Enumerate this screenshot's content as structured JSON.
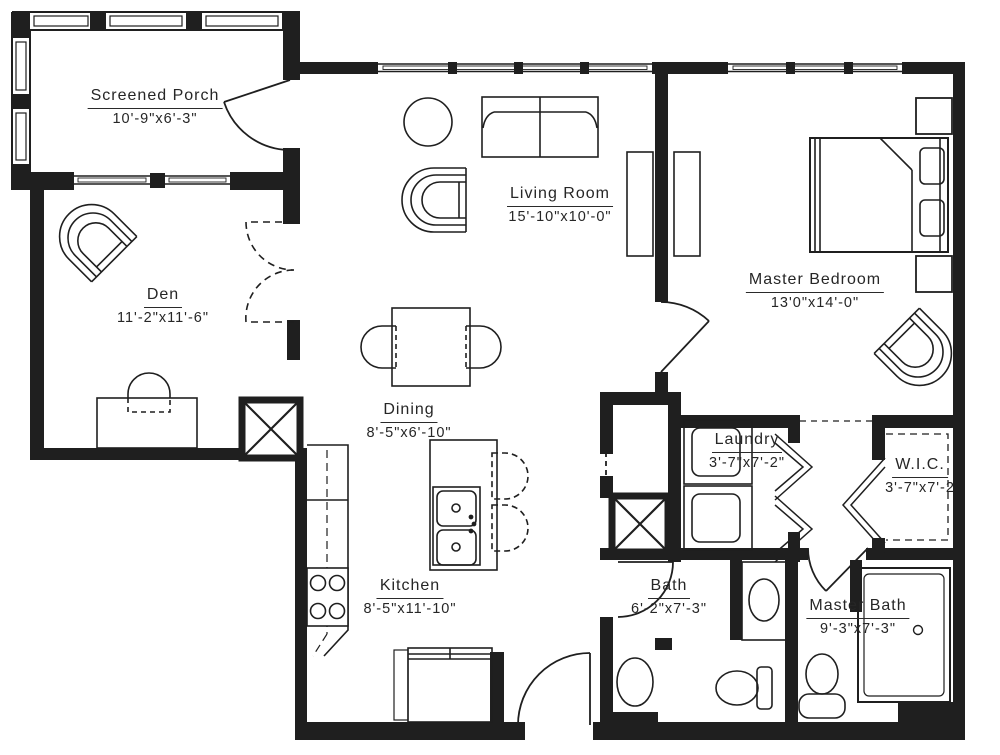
{
  "rooms": [
    {
      "id": "screened-porch",
      "name": "Screened Porch",
      "dims": "10'-9\"x6'-3\""
    },
    {
      "id": "living-room",
      "name": "Living Room",
      "dims": "15'-10\"x10'-0\""
    },
    {
      "id": "master-bedroom",
      "name": "Master Bedroom",
      "dims": "13'0\"x14'-0\""
    },
    {
      "id": "den",
      "name": "Den",
      "dims": "11'-2\"x11'-6\""
    },
    {
      "id": "dining",
      "name": "Dining",
      "dims": "8'-5\"x6'-10\""
    },
    {
      "id": "laundry",
      "name": "Laundry",
      "dims": "3'-7\"x7'-2\""
    },
    {
      "id": "wic",
      "name": "W.I.C.",
      "dims": "3'-7\"x7'-2"
    },
    {
      "id": "kitchen",
      "name": "Kitchen",
      "dims": "8'-5\"x11'-10\""
    },
    {
      "id": "bath",
      "name": "Bath",
      "dims": "6'-2\"x7'-3\""
    },
    {
      "id": "master-bath",
      "name": "Master Bath",
      "dims": "9'-3\"x7'-3\""
    }
  ],
  "colors": {
    "ink": "#1f1f1f",
    "background": "#ffffff"
  }
}
